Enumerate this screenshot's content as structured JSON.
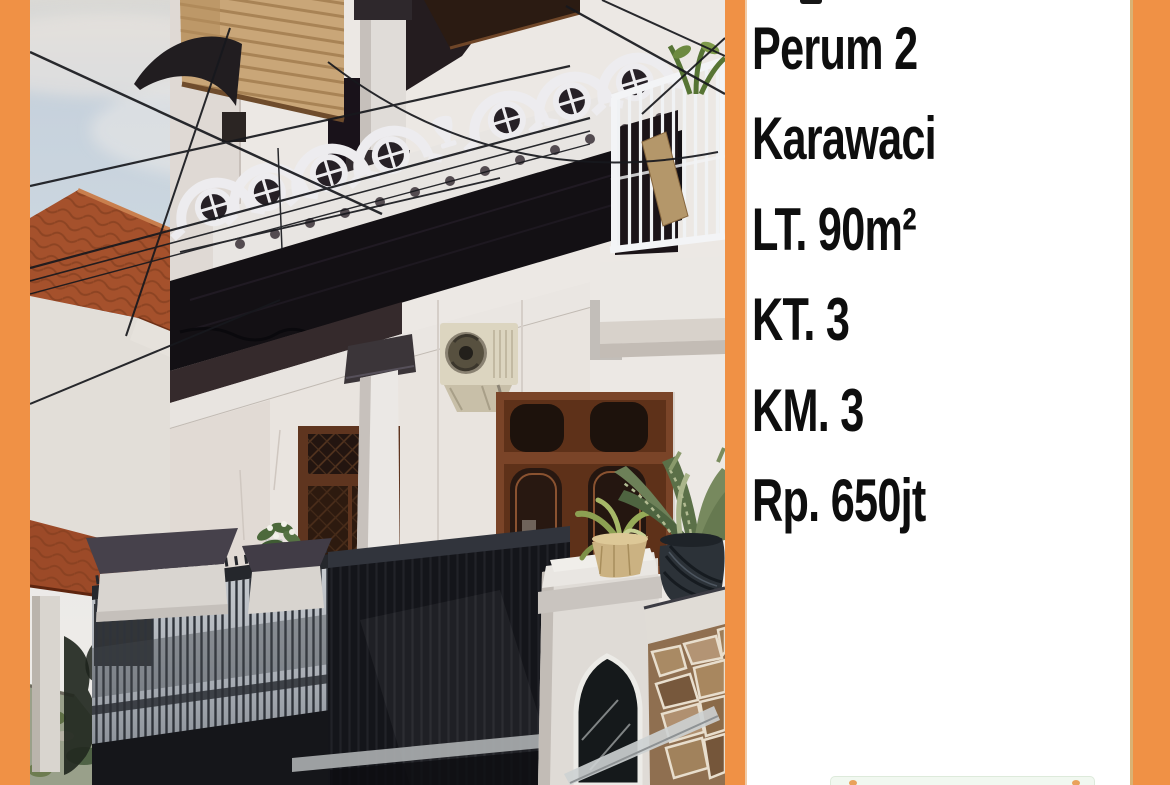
{
  "listing": {
    "lines": [
      "Perum 2",
      "Karawaci",
      "LT. 90m²",
      "KT. 3",
      "KM. 3",
      "Rp. 650jt"
    ]
  },
  "photo": {
    "alt": "Street photo of a multi-storey house with ornate white balcony arches, dark wooden doors, a black metal fence and gate, potted plants, a utility pole and overhead cables"
  },
  "colors": {
    "frame_orange": "#f09145",
    "panel_white": "#ffffff",
    "text_black": "#0e0e0e",
    "watermark_green": "#f1f8f0",
    "watermark_orange": "#e9a25b"
  }
}
